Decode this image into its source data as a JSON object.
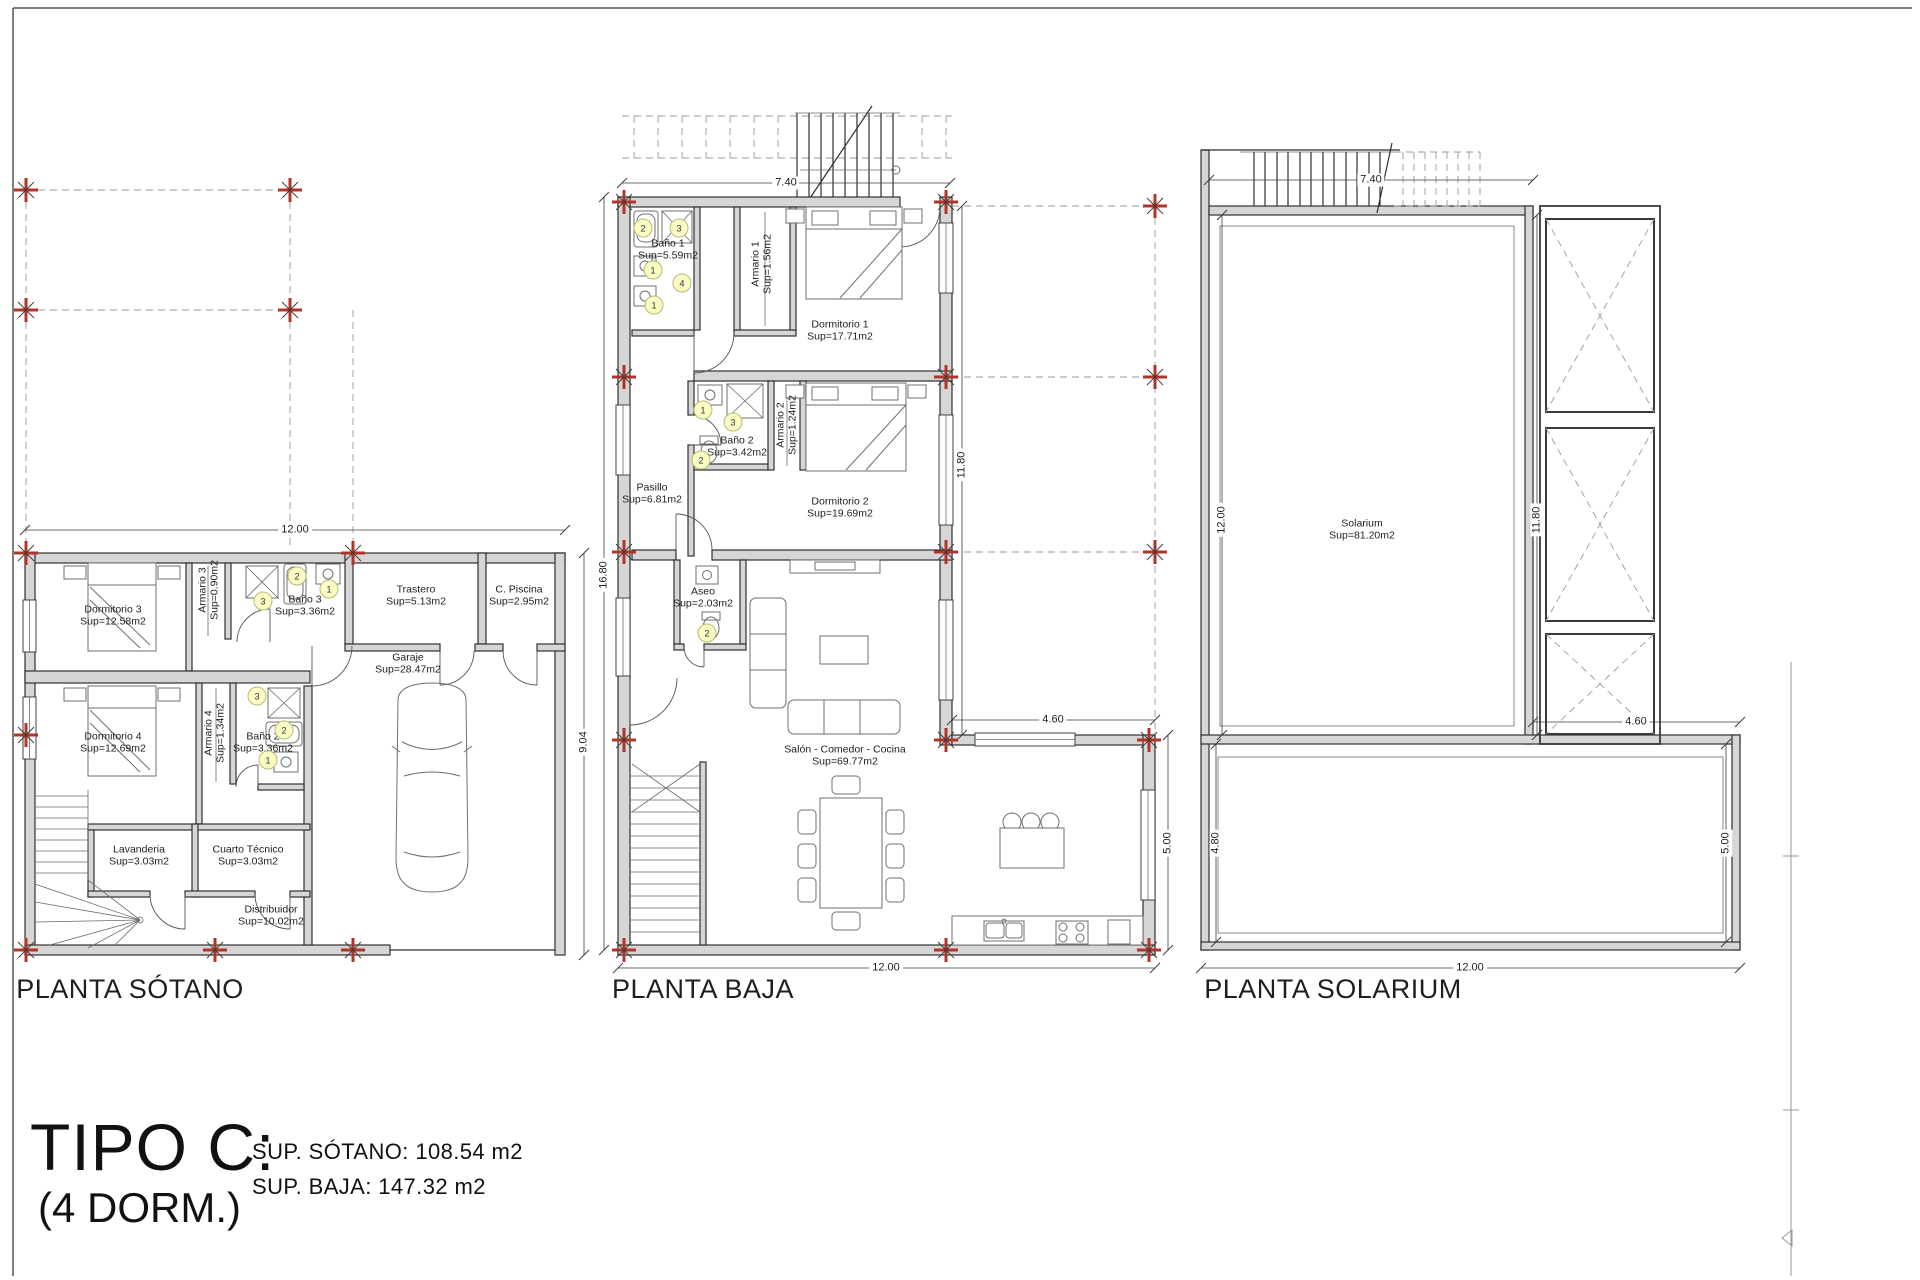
{
  "page": {
    "type_title": "TIPO C:",
    "type_subtitle": "(4 DORM.)",
    "area_summary": [
      "SUP. SÓTANO: 108.54 m2",
      "SUP. BAJA: 147.32 m2"
    ]
  },
  "colors": {
    "wall_fill": "#d6d6d6",
    "line": "#2f2f2f",
    "column_marker_red": "#b03427",
    "fixture_key_fill": "#fbfbc4"
  },
  "labels": [
    {
      "t": "Dormitorio 3\nSup=12.58m2",
      "x": 113,
      "y": 616,
      "c": "room"
    },
    {
      "t": "Armario 3\nSup=0.90m2",
      "x": 209,
      "y": 590,
      "r": -90,
      "c": "room"
    },
    {
      "t": "Baño 3\nSup=3.36m2",
      "x": 305,
      "y": 606,
      "c": "room"
    },
    {
      "t": "Trastero\nSup=5.13m2",
      "x": 416,
      "y": 596,
      "c": "room"
    },
    {
      "t": "C. Piscina\nSup=2.95m2",
      "x": 519,
      "y": 596,
      "c": "room"
    },
    {
      "t": "Garaje\nSup=28.47m2",
      "x": 408,
      "y": 664,
      "c": "room"
    },
    {
      "t": "Dormitorio 4\nSup=12.69m2",
      "x": 113,
      "y": 743,
      "c": "room"
    },
    {
      "t": "Armario 4\nSup=1.34m2",
      "x": 215,
      "y": 733,
      "r": -90,
      "c": "room"
    },
    {
      "t": "Baño 2\nSup=3.36m2",
      "x": 263,
      "y": 743,
      "c": "room"
    },
    {
      "t": "Lavanderia\nSup=3.03m2",
      "x": 139,
      "y": 856,
      "c": "room"
    },
    {
      "t": "Cuarto Técnico\nSup=3.03m2",
      "x": 248,
      "y": 856,
      "c": "room"
    },
    {
      "t": "Distribuidor\nSup=10.02m2",
      "x": 271,
      "y": 916,
      "c": "room"
    },
    {
      "t": "Baño 1\nSup=5.59m2",
      "x": 668,
      "y": 250,
      "c": "room"
    },
    {
      "t": "Armario 1\nSup=1.56m2",
      "x": 762,
      "y": 264,
      "r": -90,
      "c": "room"
    },
    {
      "t": "Dormitorio 1\nSup=17.71m2",
      "x": 840,
      "y": 331,
      "c": "room"
    },
    {
      "t": "Baño 2\nSup=3.42m2",
      "x": 737,
      "y": 447,
      "c": "room"
    },
    {
      "t": "Armario 2\nSup=1.24m2",
      "x": 787,
      "y": 425,
      "r": -90,
      "c": "room"
    },
    {
      "t": "Dormitorio 2\nSup=19.69m2",
      "x": 840,
      "y": 508,
      "c": "room"
    },
    {
      "t": "Pasillo\nSup=6.81m2",
      "x": 652,
      "y": 494,
      "c": "room"
    },
    {
      "t": "Aseo\nSup=2.03m2",
      "x": 703,
      "y": 598,
      "c": "room"
    },
    {
      "t": "Salón - Comedor - Cocina\nSup=69.77m2",
      "x": 845,
      "y": 756,
      "c": "room"
    },
    {
      "t": "Solarium\nSup=81.20m2",
      "x": 1362,
      "y": 530,
      "c": "room"
    },
    {
      "t": "12.00",
      "x": 295,
      "y": 530,
      "c": "dim"
    },
    {
      "t": "9.04",
      "x": 584,
      "y": 742,
      "r": -90,
      "c": "dim"
    },
    {
      "t": "7.40",
      "x": 786,
      "y": 183,
      "c": "dim"
    },
    {
      "t": "16.80",
      "x": 604,
      "y": 575,
      "r": -90,
      "c": "dim"
    },
    {
      "t": "11.80",
      "x": 962,
      "y": 465,
      "r": -90,
      "c": "dim"
    },
    {
      "t": "4.60",
      "x": 1053,
      "y": 720,
      "c": "dim"
    },
    {
      "t": "5.00",
      "x": 1168,
      "y": 843,
      "r": -90,
      "c": "dim"
    },
    {
      "t": "12.00",
      "x": 886,
      "y": 968,
      "c": "dim"
    },
    {
      "t": "7.40",
      "x": 1371,
      "y": 180,
      "c": "dim"
    },
    {
      "t": "12.00",
      "x": 1222,
      "y": 520,
      "r": -90,
      "c": "dim"
    },
    {
      "t": "11.80",
      "x": 1537,
      "y": 520,
      "r": -90,
      "c": "dim"
    },
    {
      "t": "4.60",
      "x": 1636,
      "y": 722,
      "c": "dim"
    },
    {
      "t": "4.80",
      "x": 1216,
      "y": 843,
      "r": -90,
      "c": "dim"
    },
    {
      "t": "5.00",
      "x": 1726,
      "y": 843,
      "r": -90,
      "c": "dim"
    },
    {
      "t": "12.00",
      "x": 1470,
      "y": 968,
      "c": "dim"
    },
    {
      "t": "PLANTA SÓTANO",
      "x": 130,
      "y": 990,
      "c": "title",
      "n": "plan-title-sotano"
    },
    {
      "t": "PLANTA BAJA",
      "x": 703,
      "y": 990,
      "c": "title",
      "n": "plan-title-baja"
    },
    {
      "t": "PLANTA SOLARIUM",
      "x": 1333,
      "y": 990,
      "c": "title",
      "n": "plan-title-solarium"
    }
  ],
  "fixture_keys": [
    {
      "n": "2",
      "x": 297,
      "y": 576
    },
    {
      "n": "1",
      "x": 329,
      "y": 589
    },
    {
      "n": "3",
      "x": 263,
      "y": 601
    },
    {
      "n": "3",
      "x": 257,
      "y": 696
    },
    {
      "n": "2",
      "x": 284,
      "y": 730
    },
    {
      "n": "1",
      "x": 268,
      "y": 760
    },
    {
      "n": "2",
      "x": 643,
      "y": 228
    },
    {
      "n": "3",
      "x": 679,
      "y": 228
    },
    {
      "n": "1",
      "x": 653,
      "y": 270
    },
    {
      "n": "4",
      "x": 682,
      "y": 283
    },
    {
      "n": "1",
      "x": 654,
      "y": 305
    },
    {
      "n": "1",
      "x": 703,
      "y": 410
    },
    {
      "n": "3",
      "x": 733,
      "y": 422
    },
    {
      "n": "2",
      "x": 701,
      "y": 460
    },
    {
      "n": "2",
      "x": 707,
      "y": 633
    }
  ]
}
